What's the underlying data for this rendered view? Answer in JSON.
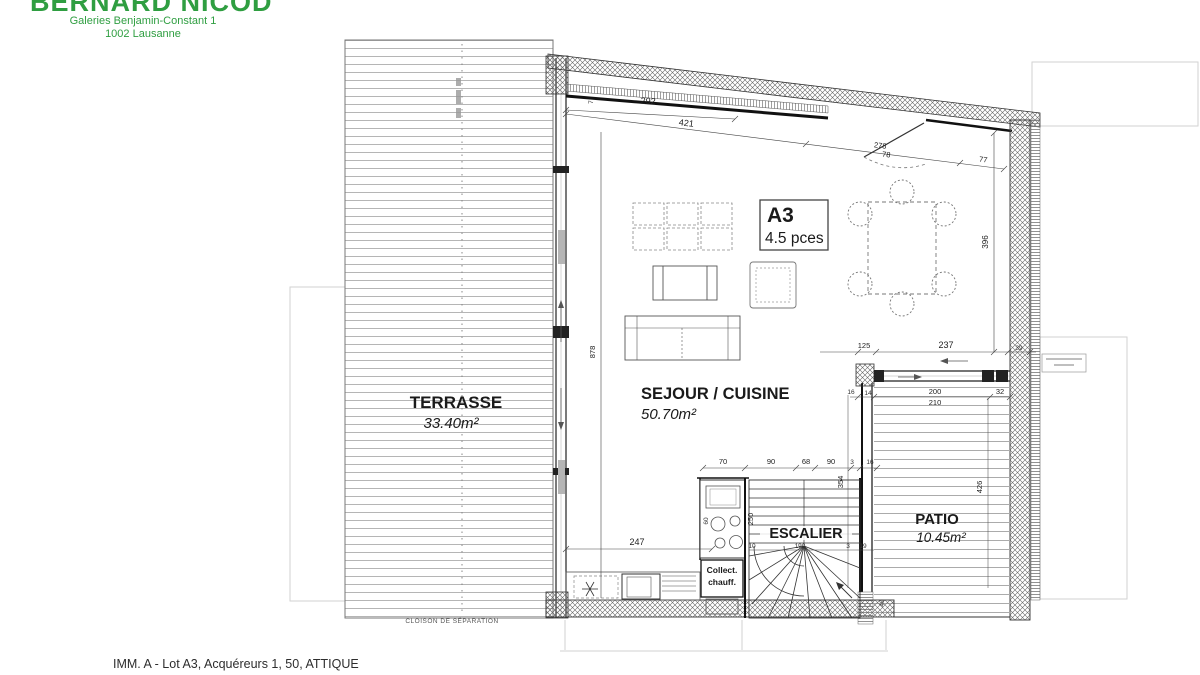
{
  "header": {
    "brand": "BERNARD NICOD",
    "address1": "Galeries Benjamin-Constant 1",
    "address2": "1002 Lausanne"
  },
  "footer": {
    "caption": "IMM. A - Lot A3, Acquéreurs 1, 50, ATTIQUE"
  },
  "plan": {
    "unit": {
      "code": "A3",
      "size": "4.5 pces"
    },
    "rooms": {
      "terrasse": {
        "name": "TERRASSE",
        "area": "33.40m²"
      },
      "sejour": {
        "name": "SEJOUR / CUISINE",
        "area": "50.70m²"
      },
      "patio": {
        "name": "PATIO",
        "area": "10.45m²"
      },
      "escalier": {
        "name": "ESCALIER"
      }
    },
    "labels": {
      "collect1": "Collect.",
      "collect2": "chauff.",
      "cloison": "CLOISON DE SÉPARATION"
    },
    "dims": {
      "top_292": "292",
      "top_421": "421",
      "top_278": "278",
      "top_78": "78",
      "top_77": "77",
      "top_7": "7",
      "left_878": "878",
      "right_396": "396",
      "patio_125": "125",
      "patio_237": "237",
      "patio_39": "39",
      "patio_16": "16",
      "patio_14": "14",
      "patio_200": "200",
      "patio_210": "210",
      "patio_32": "32",
      "patio_354": "354",
      "patio_426": "426",
      "patio_49": "49",
      "row_70": "70",
      "row_90a": "90",
      "row_68": "68",
      "row_90b": "90",
      "row_3": "3",
      "row_16": "16",
      "kitchen_247": "247",
      "kitchen_60": "60",
      "stair_250": "250",
      "stair_10": "10",
      "stair_190": "190",
      "stair_3": "3",
      "stair_19": "19"
    }
  },
  "colors": {
    "brand_green": "#2f9e41"
  }
}
